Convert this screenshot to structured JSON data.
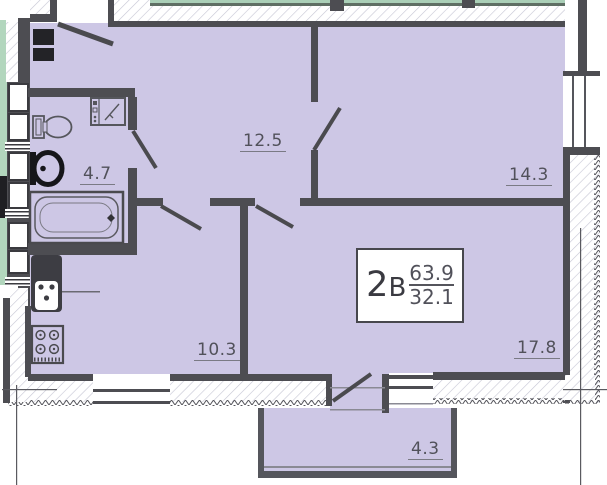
{
  "plan": {
    "apartment_label": {
      "number": "2",
      "letter": "В",
      "total_area": "63.9",
      "living_area": "32.1"
    },
    "rooms": [
      {
        "id": "hallway",
        "area": "12.5"
      },
      {
        "id": "bedroom",
        "area": "14.3"
      },
      {
        "id": "bathroom",
        "area": "4.7"
      },
      {
        "id": "kitchen",
        "area": "10.3"
      },
      {
        "id": "living",
        "area": "17.8"
      },
      {
        "id": "balcony",
        "area": "4.3"
      }
    ],
    "colors": {
      "floor_fill": "#cdc7e5",
      "wall": "#4d4d52",
      "adjacent_green": "#b2d6bd",
      "fixture_stroke": "#55565c"
    },
    "fixtures": [
      "toilet-icon",
      "washing-machine-icon",
      "wash-basin-icon",
      "bathtub-icon",
      "kitchen-sink-icon",
      "stove-icon",
      "vent-shaft-icon"
    ]
  }
}
